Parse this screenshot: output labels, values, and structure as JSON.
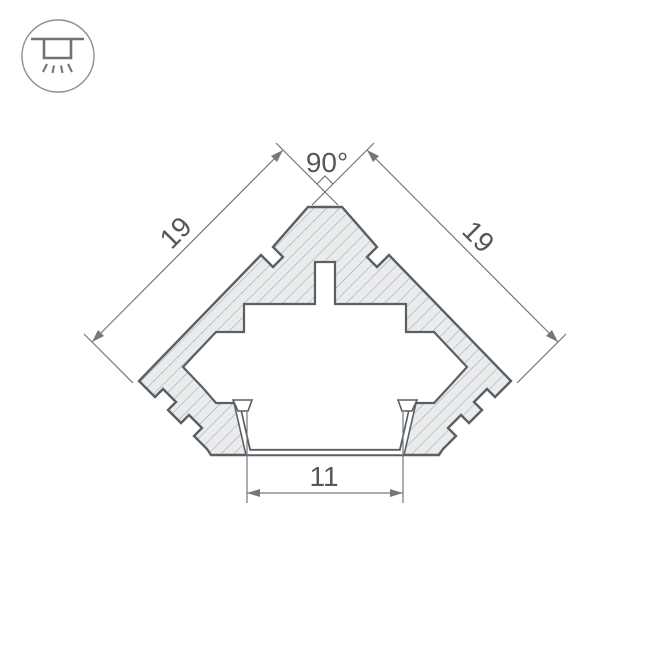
{
  "badge": {
    "icon": "recessed-light-icon"
  },
  "labels": {
    "angle": "90°",
    "side_left": "19",
    "side_right": "19",
    "opening_width": "11"
  },
  "colors": {
    "background": "#ffffff",
    "profile_outline": "#5a5f64",
    "profile_fill": "#e9ebec",
    "hatch_line": "#9ba1a6",
    "dimension_line": "#73787c",
    "label_text": "#54585c",
    "icon_stroke": "#8a9096",
    "icon_glyph": "#6d7379"
  }
}
